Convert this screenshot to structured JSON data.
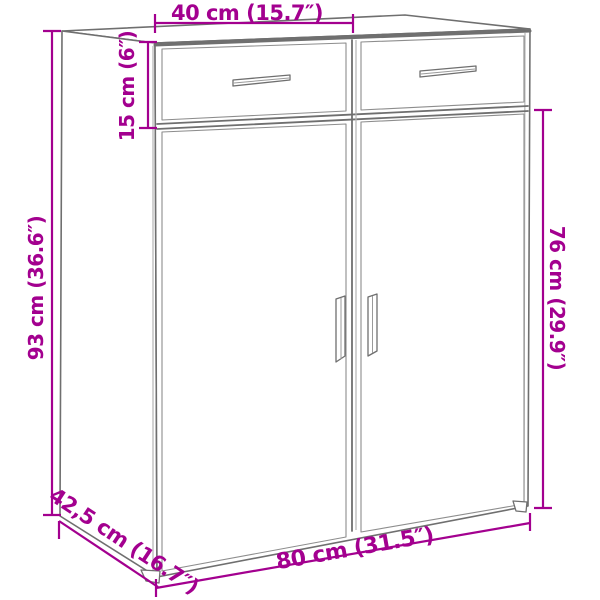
{
  "diagram": {
    "kind": "furniture-dimension-diagram",
    "subject": "Line drawing of a sideboard cabinet with 2 drawers and 2 doors, shown in perspective with measurement lines",
    "colors": {
      "dimension_accent": "#a3008f",
      "drawing_outline": "#6f6f6f",
      "background": "#ffffff"
    },
    "dimensions": {
      "top_section_width": {
        "label": "40 cm (15.7″)"
      },
      "drawer_section_height": {
        "label": "15 cm (6″)"
      },
      "total_height": {
        "label": "93 cm (36.6″)"
      },
      "door_section_height": {
        "label": "76 cm (29.9″)"
      },
      "total_width": {
        "label": "80 cm (31.5″)"
      },
      "depth": {
        "label": "42,5 cm (16.7″)"
      }
    }
  }
}
